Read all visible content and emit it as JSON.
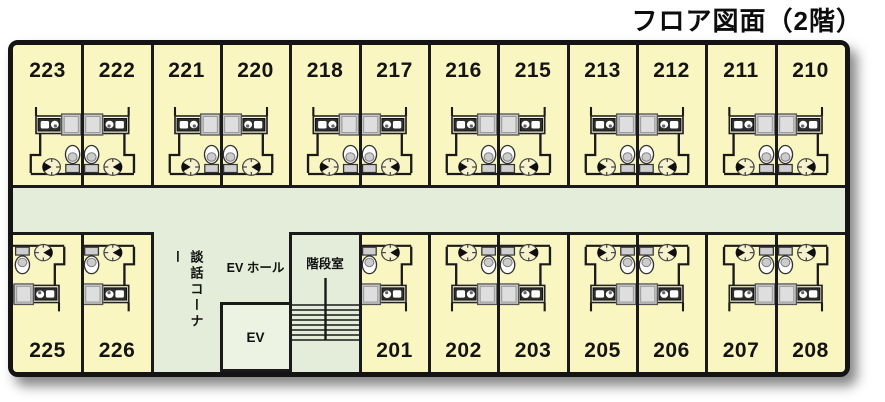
{
  "title": "フロア図面（2階）",
  "legend_labels": {
    "lounge": "談話コーナー",
    "ev_hall": "EV ホール",
    "elevator": "EV",
    "stairwell": "階段室"
  },
  "rooms": {
    "top_row": [
      {
        "number": "223",
        "fixtures": "right"
      },
      {
        "number": "222",
        "fixtures": "left"
      },
      {
        "number": "221",
        "fixtures": "right"
      },
      {
        "number": "220",
        "fixtures": "left"
      },
      {
        "number": "218",
        "fixtures": "right"
      },
      {
        "number": "217",
        "fixtures": "left"
      },
      {
        "number": "216",
        "fixtures": "right"
      },
      {
        "number": "215",
        "fixtures": "left"
      },
      {
        "number": "213",
        "fixtures": "right"
      },
      {
        "number": "212",
        "fixtures": "left"
      },
      {
        "number": "211",
        "fixtures": "right"
      },
      {
        "number": "210",
        "fixtures": "left"
      }
    ],
    "bottom_left_row": [
      {
        "number": "225",
        "fixtures": "left"
      },
      {
        "number": "226",
        "fixtures": "left"
      }
    ],
    "bottom_right_row": [
      {
        "number": "201",
        "fixtures": "left"
      },
      {
        "number": "202",
        "fixtures": "right"
      },
      {
        "number": "203",
        "fixtures": "left"
      },
      {
        "number": "205",
        "fixtures": "right"
      },
      {
        "number": "206",
        "fixtures": "left"
      },
      {
        "number": "207",
        "fixtures": "right"
      },
      {
        "number": "208",
        "fixtures": "left"
      }
    ]
  },
  "colors": {
    "room_fill": "#faf6c1",
    "corridor_fill": "#e4edd9",
    "wall": "#1a1a1a",
    "elevator_fill": "#edf3e3",
    "bath_fill": "#c7c7c7",
    "sink_fill": "#2e2e2e"
  }
}
